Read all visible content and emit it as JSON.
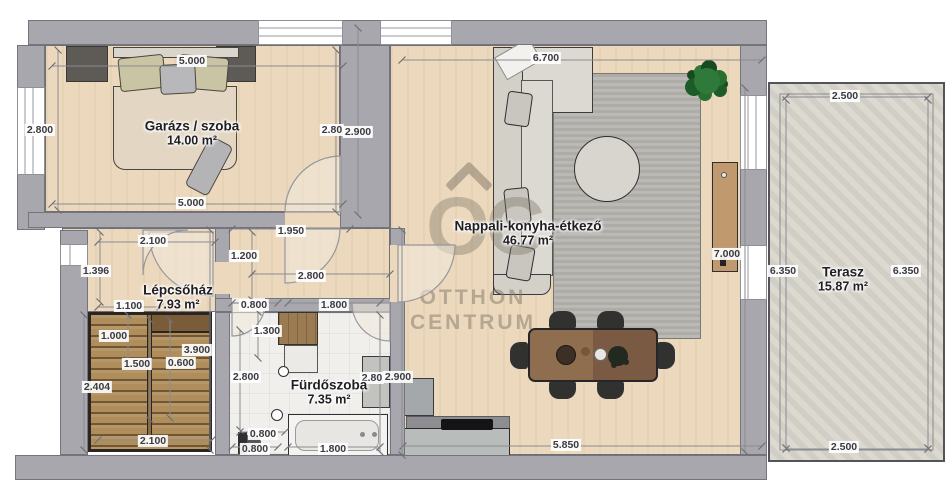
{
  "watermark": {
    "logo_text": "OC",
    "line1": "OTTHON",
    "line2": "CENTRUM"
  },
  "rooms": [
    {
      "id": "garage",
      "name": "Garázs / szoba",
      "area": "14.00 m²",
      "x": 192,
      "y": 133
    },
    {
      "id": "living",
      "name": "Nappali-konyha-étkező",
      "area": "46.77 m²",
      "x": 528,
      "y": 233
    },
    {
      "id": "staircase",
      "name": "Lépcsőház",
      "area": "7.93 m²",
      "x": 178,
      "y": 297
    },
    {
      "id": "bathroom",
      "name": "Fürdőszoba",
      "area": "7.35 m²",
      "x": 329,
      "y": 392
    },
    {
      "id": "terrace",
      "name": "Terasz",
      "area": "15.87 m²",
      "x": 843,
      "y": 279
    }
  ],
  "dimensions": [
    {
      "text": "5.000",
      "x": 192,
      "y": 61
    },
    {
      "text": "6.700",
      "x": 546,
      "y": 58
    },
    {
      "text": "2.800",
      "x": 40,
      "y": 130
    },
    {
      "text": "2.80",
      "x": 332,
      "y": 130
    },
    {
      "text": "2.900",
      "x": 358,
      "y": 132
    },
    {
      "text": "5.000",
      "x": 191,
      "y": 203
    },
    {
      "text": "2.500",
      "x": 845,
      "y": 96
    },
    {
      "text": "1.950",
      "x": 291,
      "y": 231
    },
    {
      "text": "2.100",
      "x": 153,
      "y": 241
    },
    {
      "text": "1.200",
      "x": 244,
      "y": 256
    },
    {
      "text": "1.396",
      "x": 96,
      "y": 271
    },
    {
      "text": "2.800",
      "x": 311,
      "y": 276
    },
    {
      "text": "1.100",
      "x": 129,
      "y": 306
    },
    {
      "text": "0.800",
      "x": 254,
      "y": 305
    },
    {
      "text": "1.800",
      "x": 334,
      "y": 305
    },
    {
      "text": "7.000",
      "x": 727,
      "y": 254
    },
    {
      "text": "6.350",
      "x": 783,
      "y": 271
    },
    {
      "text": "6.350",
      "x": 906,
      "y": 271
    },
    {
      "text": "1.000",
      "x": 114,
      "y": 336
    },
    {
      "text": "3.900",
      "x": 197,
      "y": 350
    },
    {
      "text": "1.500",
      "x": 137,
      "y": 364
    },
    {
      "text": "0.600",
      "x": 181,
      "y": 363
    },
    {
      "text": "1.300",
      "x": 267,
      "y": 331
    },
    {
      "text": "2.404",
      "x": 97,
      "y": 387
    },
    {
      "text": "2.800",
      "x": 246,
      "y": 377
    },
    {
      "text": "2.80",
      "x": 372,
      "y": 378
    },
    {
      "text": "2.900",
      "x": 398,
      "y": 377
    },
    {
      "text": "0.800",
      "x": 263,
      "y": 434
    },
    {
      "text": "0.800",
      "x": 255,
      "y": 449
    },
    {
      "text": "1.800",
      "x": 333,
      "y": 449
    },
    {
      "text": "2.100",
      "x": 153,
      "y": 441
    },
    {
      "text": "5.850",
      "x": 566,
      "y": 445
    },
    {
      "text": "2.500",
      "x": 844,
      "y": 447
    }
  ]
}
